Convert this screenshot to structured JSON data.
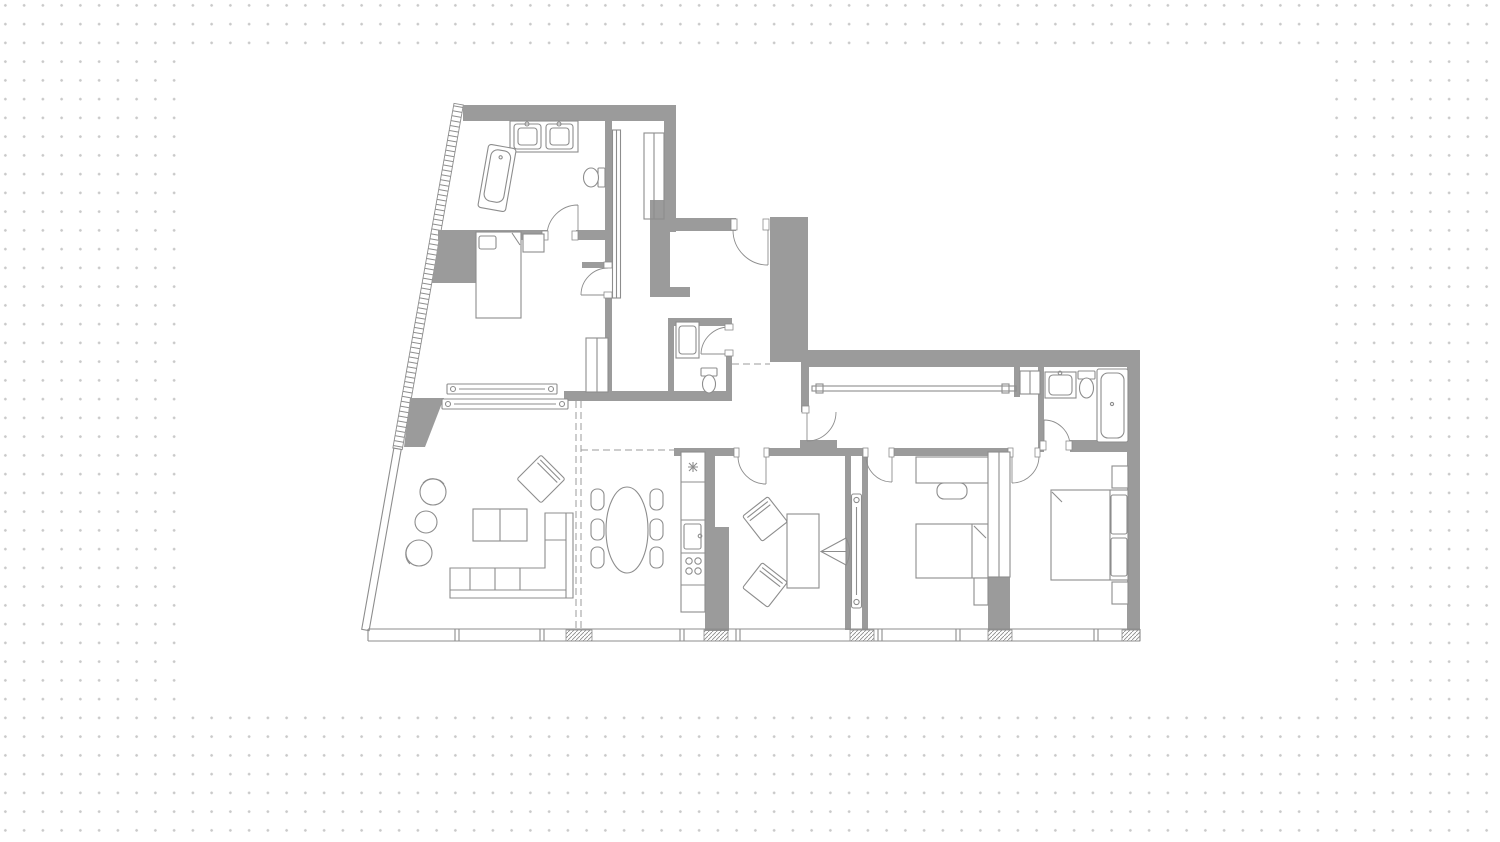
{
  "canvas": {
    "width": 1500,
    "height": 842
  },
  "background": {
    "paper_color": "#ffffff",
    "dot_color": "#c9c9c9",
    "dot_spacing_px": 18.75,
    "dot_free_area": {
      "left": 180,
      "top": 50,
      "width": 1142,
      "height": 663
    }
  },
  "colors": {
    "wall_fill": "#9b9b9b",
    "line": "#8d8d8d",
    "dash": "#9b9b9b",
    "fixture_fill": "#ffffff"
  },
  "drawing": {
    "kind": "apartment-floor-plan",
    "rooms": [
      "master-bathroom",
      "master-bedroom",
      "dressing-corridor",
      "entry-hall",
      "wc",
      "living-room",
      "dining-area",
      "kitchen",
      "study",
      "hall-corridor",
      "bedroom-2",
      "bedroom-3",
      "bathroom-2"
    ],
    "fixture_icons": [
      "bathtub-icon",
      "double-sink-icon",
      "toilet-icon",
      "bed-icon",
      "sofa-icon",
      "coffee-table-icon",
      "dining-table-icon",
      "chair-icon",
      "desk-icon",
      "stove-icon",
      "kitchen-sink-icon",
      "fridge-icon",
      "sliding-door-icon",
      "door-swing-icon",
      "window-icon"
    ]
  }
}
